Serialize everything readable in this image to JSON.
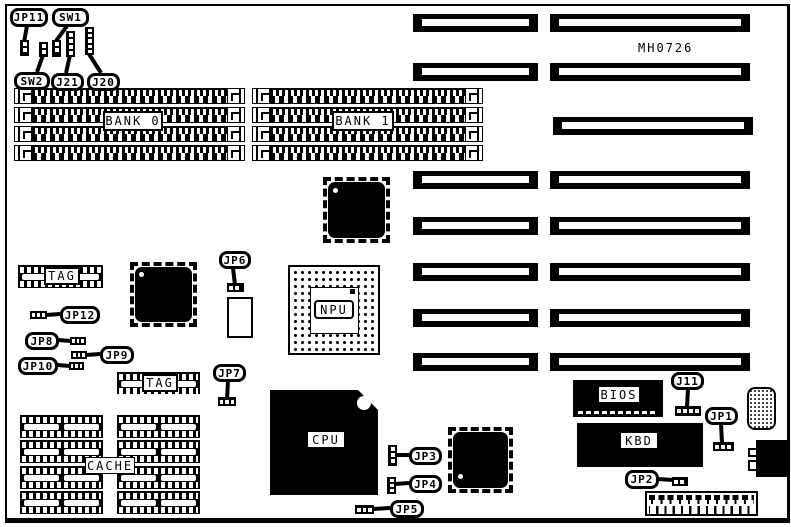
{
  "board": {
    "model": "MH0726"
  },
  "labels": {
    "bank0": "BANK 0",
    "bank1": "BANK 1",
    "tag_upper": "TAG",
    "tag_lower": "TAG",
    "cache": "CACHE",
    "npu": "NPU",
    "cpu": "CPU",
    "bios": "BIOS",
    "kbd": "KBD"
  },
  "callouts": {
    "jp11": "JP11",
    "sw1": "SW1",
    "sw2": "SW2",
    "j21": "J21",
    "j20": "J20",
    "jp6": "JP6",
    "jp12": "JP12",
    "jp8": "JP8",
    "jp9": "JP9",
    "jp10": "JP10",
    "jp7": "JP7",
    "jp3": "JP3",
    "jp4": "JP4",
    "jp5": "JP5",
    "j11": "J11",
    "jp1": "JP1",
    "jp2": "JP2"
  }
}
